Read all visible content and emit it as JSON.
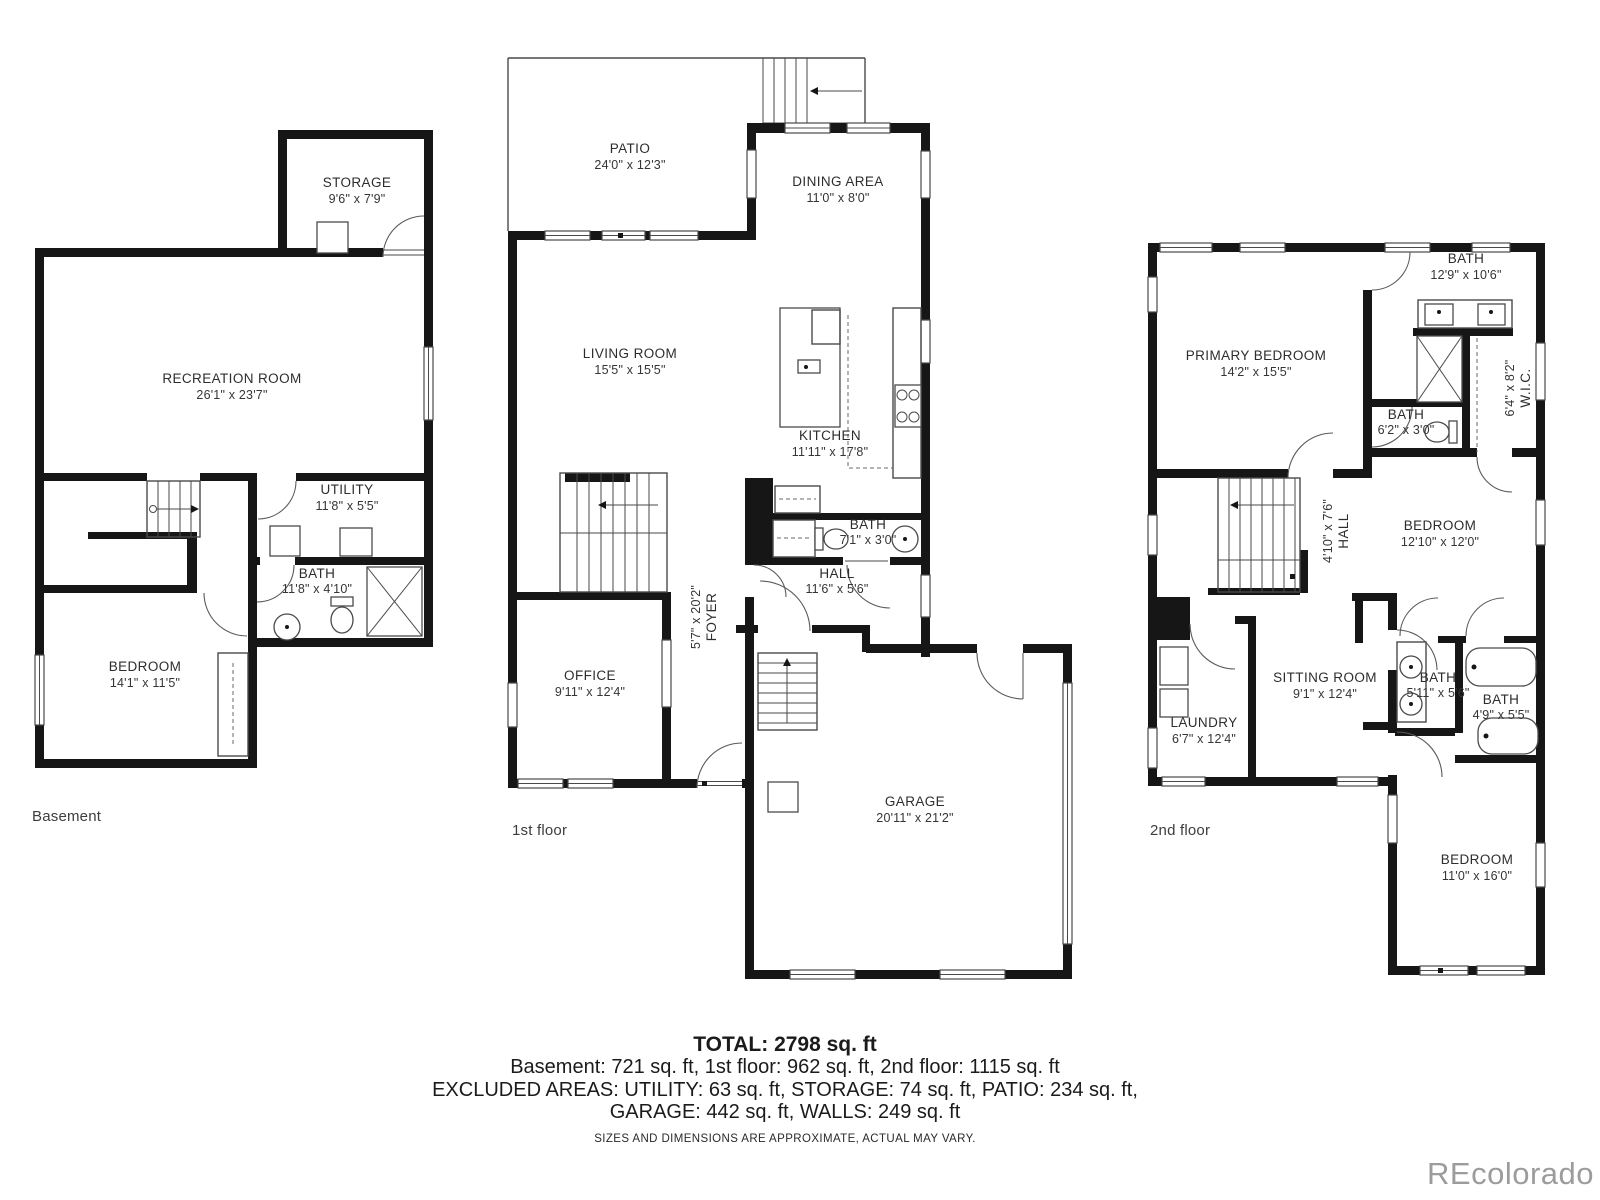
{
  "watermark": "REcolorado",
  "colors": {
    "wall": "#161616",
    "text": "#2d2d2d",
    "watermark": "#9c9c9c"
  },
  "floors": {
    "basement": {
      "label": "Basement",
      "rooms": [
        {
          "name": "STORAGE",
          "dims": "9'6\" x 7'9\""
        },
        {
          "name": "RECREATION ROOM",
          "dims": "26'1\" x 23'7\""
        },
        {
          "name": "UTILITY",
          "dims": "11'8\" x 5'5\""
        },
        {
          "name": "BATH",
          "dims": "11'8\" x 4'10\""
        },
        {
          "name": "BEDROOM",
          "dims": "14'1\" x 11'5\""
        }
      ]
    },
    "first": {
      "label": "1st floor",
      "rooms": [
        {
          "name": "PATIO",
          "dims": "24'0\" x 12'3\""
        },
        {
          "name": "DINING AREA",
          "dims": "11'0\" x 8'0\""
        },
        {
          "name": "LIVING ROOM",
          "dims": "15'5\" x 15'5\""
        },
        {
          "name": "KITCHEN",
          "dims": "11'11\" x 17'8\""
        },
        {
          "name": "BATH",
          "dims": "7'1\" x 3'0\""
        },
        {
          "name": "HALL",
          "dims": "11'6\" x 5'6\""
        },
        {
          "name": "FOYER",
          "dims": "5'7\" x 20'2\""
        },
        {
          "name": "OFFICE",
          "dims": "9'11\" x 12'4\""
        },
        {
          "name": "GARAGE",
          "dims": "20'11\" x 21'2\""
        }
      ]
    },
    "second": {
      "label": "2nd floor",
      "rooms": [
        {
          "name": "PRIMARY BEDROOM",
          "dims": "14'2\" x 15'5\""
        },
        {
          "name": "BATH",
          "dims": "12'9\" x 10'6\""
        },
        {
          "name": "W.I.C.",
          "dims": "6'4\" x 8'2\""
        },
        {
          "name": "BATH",
          "dims": "6'2\" x 3'0\""
        },
        {
          "name": "HALL",
          "dims": "4'10\" x 7'6\""
        },
        {
          "name": "BEDROOM",
          "dims": "12'10\" x 12'0\""
        },
        {
          "name": "LAUNDRY",
          "dims": "6'7\" x 12'4\""
        },
        {
          "name": "SITTING ROOM",
          "dims": "9'1\" x 12'4\""
        },
        {
          "name": "BATH",
          "dims": "5'11\" x 5'6\""
        },
        {
          "name": "BATH",
          "dims": "4'9\" x 5'5\""
        },
        {
          "name": "BEDROOM",
          "dims": "11'0\" x 16'0\""
        }
      ]
    }
  },
  "summary": {
    "total": "TOTAL: 2798 sq. ft",
    "floors_line": "Basement: 721 sq. ft, 1st floor: 962 sq. ft, 2nd floor: 1115 sq. ft",
    "excluded_line1": "EXCLUDED AREAS: UTILITY: 63 sq. ft, STORAGE: 74 sq. ft, PATIO: 234 sq. ft,",
    "excluded_line2": "GARAGE: 442 sq. ft, WALLS: 249 sq. ft",
    "disclaimer": "SIZES AND DIMENSIONS ARE APPROXIMATE, ACTUAL MAY VARY."
  }
}
